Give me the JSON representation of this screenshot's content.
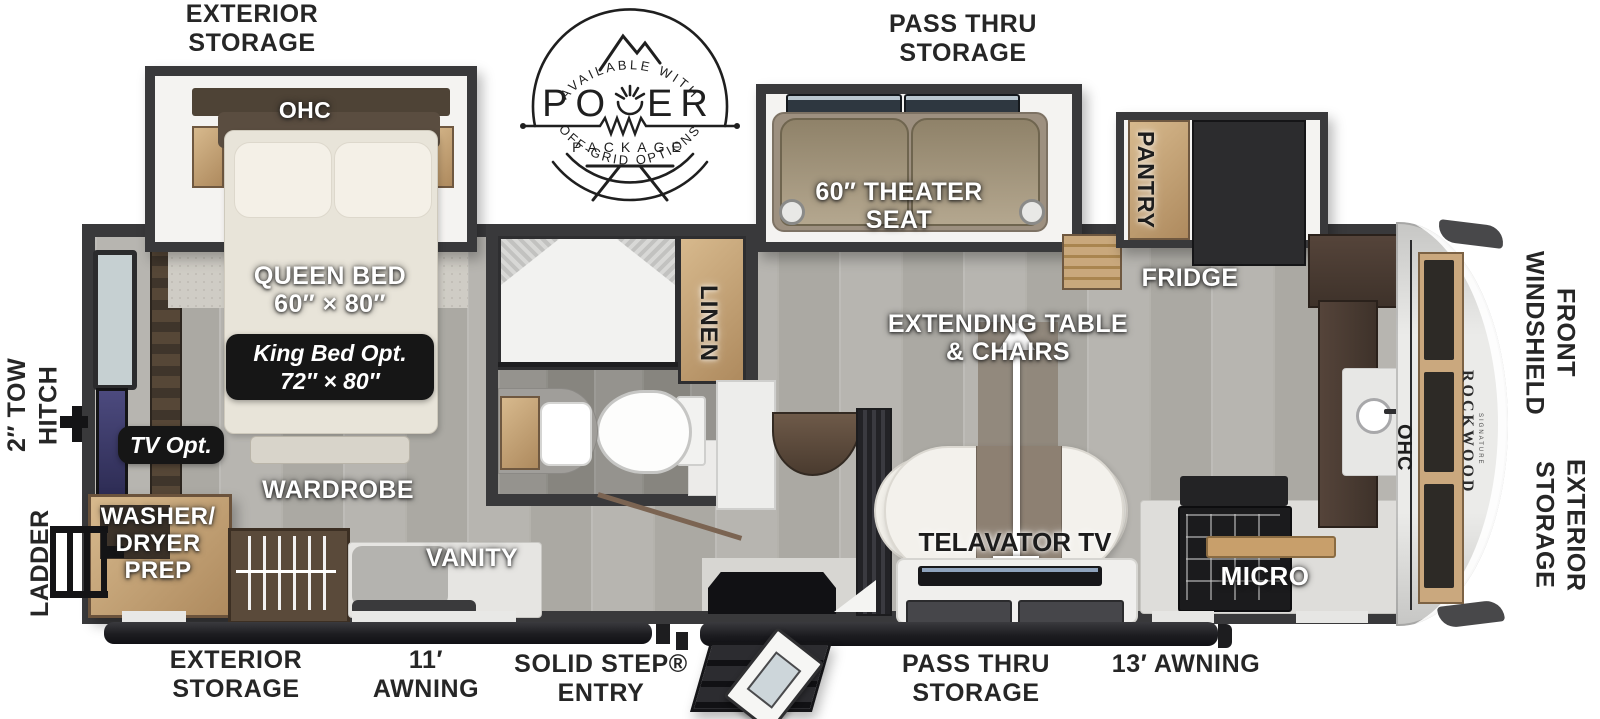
{
  "logo": {
    "top_arc_text": "AVAILABLE WITH",
    "power_left": "PO",
    "power_right": "ER",
    "package_text": "PACKAGE",
    "bottom_arc_text": "OFF-GRID OPTIONS"
  },
  "exterior_labels": {
    "storage_top_left_1": "EXTERIOR",
    "storage_top_left_2": "STORAGE",
    "pass_thru_top_1": "PASS THRU",
    "pass_thru_top_2": "STORAGE",
    "front_windshield_1": "FRONT",
    "front_windshield_2": "WINDSHIELD",
    "storage_right_1": "EXTERIOR",
    "storage_right_2": "STORAGE",
    "tow_hitch_1": "2″ TOW",
    "tow_hitch_2": "HITCH",
    "ladder": "LADDER",
    "storage_bottom_left_1": "EXTERIOR",
    "storage_bottom_left_2": "STORAGE",
    "awning_11_1": "11′",
    "awning_11_2": "AWNING",
    "solid_step_1": "SOLID STEP®",
    "solid_step_2": "ENTRY",
    "pass_thru_bottom_1": "PASS THRU",
    "pass_thru_bottom_2": "STORAGE",
    "awning_13": "13′ AWNING"
  },
  "interior_labels": {
    "ohc_bedroom": "OHC",
    "queen_bed_1": "QUEEN BED",
    "queen_bed_2": "60″ × 80″",
    "king_bed_opt_1": "King Bed Opt.",
    "king_bed_opt_2": "72″ × 80″",
    "tv_opt": "TV Opt.",
    "washer_dryer_1": "WASHER/",
    "washer_dryer_2": "DRYER",
    "washer_dryer_3": "PREP",
    "wardrobe": "WARDROBE",
    "vanity": "VANITY",
    "linen": "LINEN",
    "theater_seat_1": "60″ THEATER",
    "theater_seat_2": "SEAT",
    "pantry": "PANTRY",
    "fridge": "FRIDGE",
    "extending_table_1": "EXTENDING TABLE",
    "extending_table_2": "& CHAIRS",
    "telavator_tv": "TELAVATOR TV",
    "micro": "MICRO",
    "ohc_front": "OHC",
    "brand": "ROCKWOOD",
    "brand_sub": "SIGNATURE"
  },
  "colors": {
    "wall": "#39393b",
    "wood_cabinet": "#c7a377",
    "floor": "#b2b0ab",
    "label_dark": "#262626",
    "badge_bg": "#161616"
  }
}
